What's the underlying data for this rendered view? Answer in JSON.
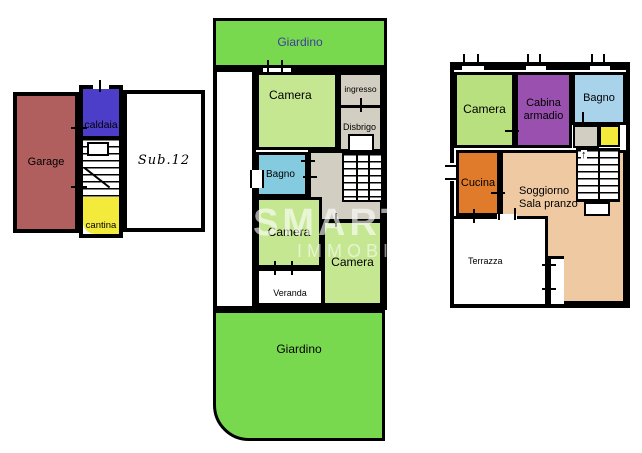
{
  "plans": {
    "ground": {
      "rooms": {
        "garage": "Garage",
        "caldaia": "caldaia",
        "sub12": "Sub.12",
        "cantina": "cantina"
      }
    },
    "first": {
      "garden_top": "Giardino",
      "garden_bottom": "Giardino",
      "rooms": {
        "camera1": "Camera",
        "ingresso": "ingresso",
        "disbrigo": "Disbrigo",
        "bagno": "Bagno",
        "camera2": "Camera",
        "camera3": "Camera",
        "veranda": "Veranda"
      }
    },
    "second": {
      "rooms": {
        "camera": "Camera",
        "cabina_armadio": "Cabina armadio",
        "bagno": "Bagno",
        "cucina": "Cucina",
        "soggiorno": "Soggiorno Sala pranzo",
        "terrazza": "Terrazza"
      }
    }
  },
  "watermark": {
    "line1": "SMART",
    "line2": "IMMOBILI"
  },
  "icons": {
    "stairs_up_arrow": "↑"
  },
  "colors": {
    "garden": "#79d94e",
    "garden_text": "#3c4099",
    "camera_mid": "#c6e792",
    "camera_right": "#b9e07e",
    "bagno_mid": "#84cbdf",
    "bagno_right": "#a8d3eb",
    "gray": "#d2cec1",
    "purple": "#9a50ae",
    "orange": "#e07b2b",
    "tan": "#eec9a2",
    "yellow": "#f3ea3c",
    "garage": "#b05e5e",
    "caldaia": "#4c3ec8",
    "wall": "#000000"
  }
}
